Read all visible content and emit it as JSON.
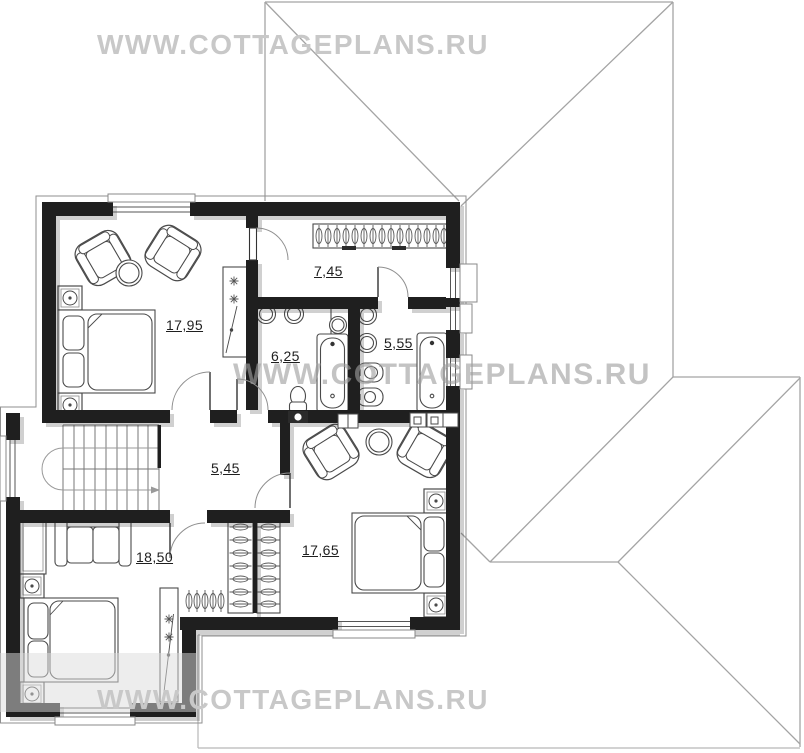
{
  "watermarks": {
    "top": "WWW.COTTAGEPLANS.RU",
    "middle": "WWW.COTTAGEPLANS.RU",
    "bottom": "WWW.COTTAGEPLANS.RU"
  },
  "rooms": [
    {
      "name": "bedroom-top-left",
      "area": "17,95"
    },
    {
      "name": "dressing-room",
      "area": "7,45"
    },
    {
      "name": "bathroom-left",
      "area": "6,25"
    },
    {
      "name": "bathroom-right",
      "area": "5,55"
    },
    {
      "name": "hall",
      "area": "5,45"
    },
    {
      "name": "bedroom-bottom-left",
      "area": "18,50"
    },
    {
      "name": "bedroom-bottom-right",
      "area": "17,65"
    }
  ],
  "colors": {
    "wall": "#1f1f1f",
    "roof_line": "#a4a4a4",
    "watermark": "#c8c8c8",
    "furniture_line": "#4a4a4a",
    "label_text": "#1f1f1f"
  }
}
